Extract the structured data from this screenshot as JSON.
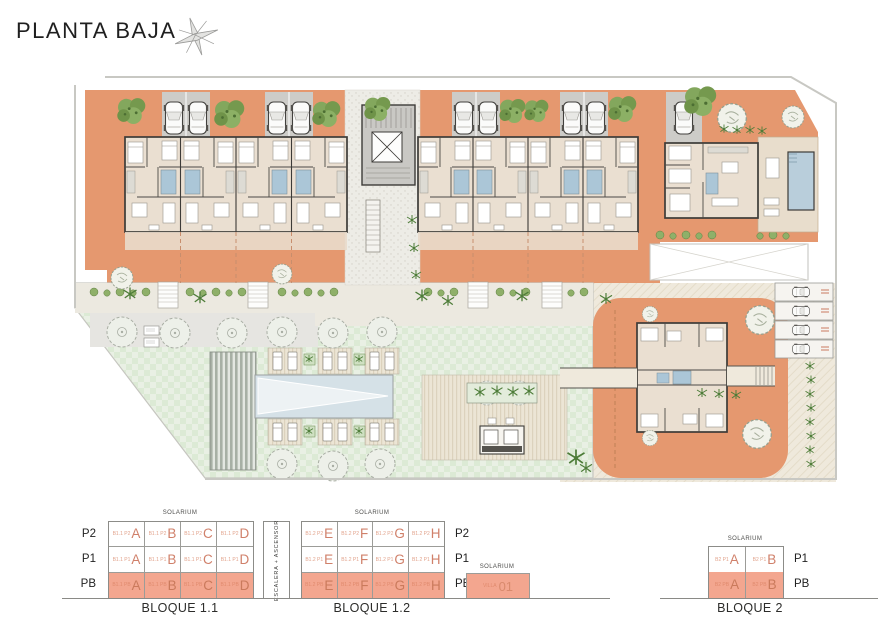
{
  "title": "PLANTA BAJA",
  "icons": {
    "compass_star": "8-point-star",
    "car": "car-top-view",
    "tree": "tree-canopy",
    "palm": "palm-plant",
    "elevator": "elevator-x-box"
  },
  "colors": {
    "terracotta": "#e5986f",
    "legend_highlight": "#f3a68f",
    "legend_accent": "#d0806a",
    "lawn": "#e7efe2",
    "pool": "#b9cedb",
    "parking": "#cdccc8",
    "floor": "#eadfd1",
    "wall": "#3d3b38"
  },
  "legend": {
    "solarium": "SOLARIUM",
    "escalera": "ESCALERA + ASCENSOR",
    "bloque11": {
      "caption": "BLOQUE 1.1",
      "rows": [
        {
          "floor": "P2",
          "highlight": false,
          "cells": [
            {
              "prefix": "B1.1 P2",
              "letter": "A"
            },
            {
              "prefix": "B1.1 P2",
              "letter": "B"
            },
            {
              "prefix": "B1.1 P2",
              "letter": "C"
            },
            {
              "prefix": "B1.1 P2",
              "letter": "D"
            }
          ]
        },
        {
          "floor": "P1",
          "highlight": false,
          "cells": [
            {
              "prefix": "B1.1 P1",
              "letter": "A"
            },
            {
              "prefix": "B1.1 P1",
              "letter": "B"
            },
            {
              "prefix": "B1.1 P1",
              "letter": "C"
            },
            {
              "prefix": "B1.1 P1",
              "letter": "D"
            }
          ]
        },
        {
          "floor": "PB",
          "highlight": true,
          "cells": [
            {
              "prefix": "B1.1 PB",
              "letter": "A"
            },
            {
              "prefix": "B1.1 PB",
              "letter": "B"
            },
            {
              "prefix": "B1.1 PB",
              "letter": "C"
            },
            {
              "prefix": "B1.1 PB",
              "letter": "D"
            }
          ]
        }
      ]
    },
    "bloque12": {
      "caption": "BLOQUE 1.2",
      "rows": [
        {
          "floor": "P2",
          "highlight": false,
          "cells": [
            {
              "prefix": "B1.2 P2",
              "letter": "E"
            },
            {
              "prefix": "B1.2 P2",
              "letter": "F"
            },
            {
              "prefix": "B1.2 P2",
              "letter": "G"
            },
            {
              "prefix": "B1.2 P2",
              "letter": "H"
            }
          ]
        },
        {
          "floor": "P1",
          "highlight": false,
          "cells": [
            {
              "prefix": "B1.2 P1",
              "letter": "E"
            },
            {
              "prefix": "B1.2 P1",
              "letter": "F"
            },
            {
              "prefix": "B1.2 P1",
              "letter": "G"
            },
            {
              "prefix": "B1.2 P1",
              "letter": "H"
            }
          ]
        },
        {
          "floor": "PB",
          "highlight": true,
          "cells": [
            {
              "prefix": "B1.2 PB",
              "letter": "E"
            },
            {
              "prefix": "B1.2 PB",
              "letter": "F"
            },
            {
              "prefix": "B1.2 PB",
              "letter": "G"
            },
            {
              "prefix": "B1.2 PB",
              "letter": "H"
            }
          ]
        }
      ]
    },
    "villa": {
      "solarium": "SOLARIUM",
      "prefix": "VILLA",
      "number": "01"
    },
    "bloque2": {
      "caption": "BLOQUE 2",
      "rows": [
        {
          "floor": "P1",
          "highlight": false,
          "cells": [
            {
              "prefix": "B2 P1",
              "letter": "A"
            },
            {
              "prefix": "B2 P1",
              "letter": "B"
            }
          ]
        },
        {
          "floor": "PB",
          "highlight": true,
          "cells": [
            {
              "prefix": "B2 PB",
              "letter": "A"
            },
            {
              "prefix": "B2 PB",
              "letter": "B"
            }
          ]
        }
      ]
    }
  }
}
